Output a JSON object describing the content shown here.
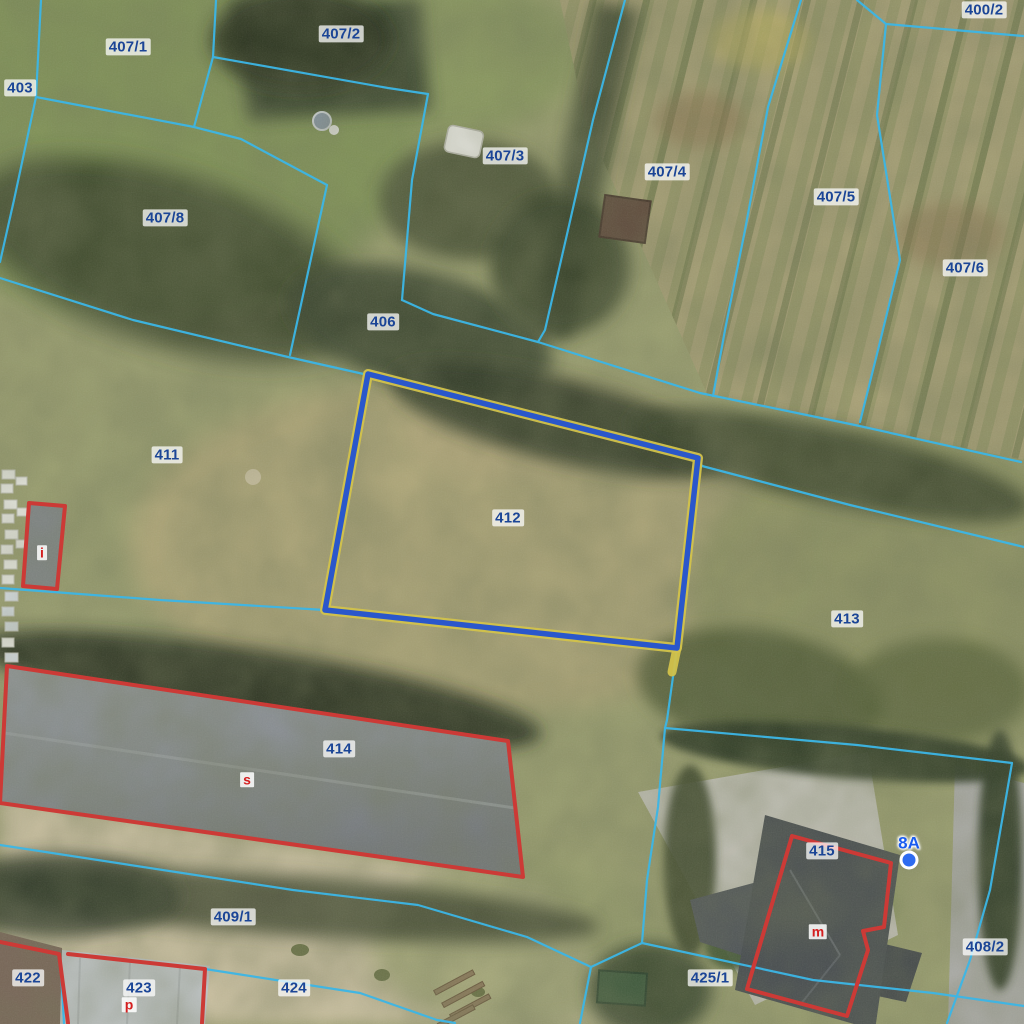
{
  "map": {
    "type": "cadastral-aerial-map",
    "colors": {
      "parcel_boundary": "#3cb6e6",
      "selected_outline": "#2a57cb",
      "selected_halo": "#d2c24b",
      "building_outline": "#cc3a36",
      "parcel_label_text": "#1b4596",
      "building_letter_text": "#d41f1f",
      "address_text": "#1a5cf0"
    },
    "selected_parcel": {
      "number": "412"
    },
    "parcel_labels": [
      {
        "number": "403",
        "x": 20,
        "y": 88
      },
      {
        "number": "407/1",
        "x": 128,
        "y": 47
      },
      {
        "number": "407/2",
        "x": 341,
        "y": 34
      },
      {
        "number": "400/2",
        "x": 984,
        "y": 10
      },
      {
        "number": "407/3",
        "x": 505,
        "y": 156
      },
      {
        "number": "407/4",
        "x": 667,
        "y": 172
      },
      {
        "number": "407/5",
        "x": 836,
        "y": 197
      },
      {
        "number": "407/6",
        "x": 965,
        "y": 268
      },
      {
        "number": "407/8",
        "x": 165,
        "y": 218
      },
      {
        "number": "406",
        "x": 383,
        "y": 322
      },
      {
        "number": "411",
        "x": 167,
        "y": 455
      },
      {
        "number": "412",
        "x": 508,
        "y": 518
      },
      {
        "number": "413",
        "x": 847,
        "y": 619
      },
      {
        "number": "414",
        "x": 339,
        "y": 749
      },
      {
        "number": "415",
        "x": 822,
        "y": 851
      },
      {
        "number": "409/1",
        "x": 233,
        "y": 917
      },
      {
        "number": "422",
        "x": 28,
        "y": 978
      },
      {
        "number": "423",
        "x": 139,
        "y": 988
      },
      {
        "number": "424",
        "x": 294,
        "y": 988
      },
      {
        "number": "425/1",
        "x": 710,
        "y": 978
      },
      {
        "number": "408/2",
        "x": 985,
        "y": 947
      }
    ],
    "building_function_labels": [
      {
        "letter": "i",
        "x": 42,
        "y": 553
      },
      {
        "letter": "s",
        "x": 247,
        "y": 780
      },
      {
        "letter": "m",
        "x": 818,
        "y": 932
      },
      {
        "letter": "p",
        "x": 129,
        "y": 1005
      }
    ],
    "address_points": [
      {
        "label": "8A",
        "x": 909,
        "y": 843,
        "dot_x": 909,
        "dot_y": 860
      }
    ]
  }
}
